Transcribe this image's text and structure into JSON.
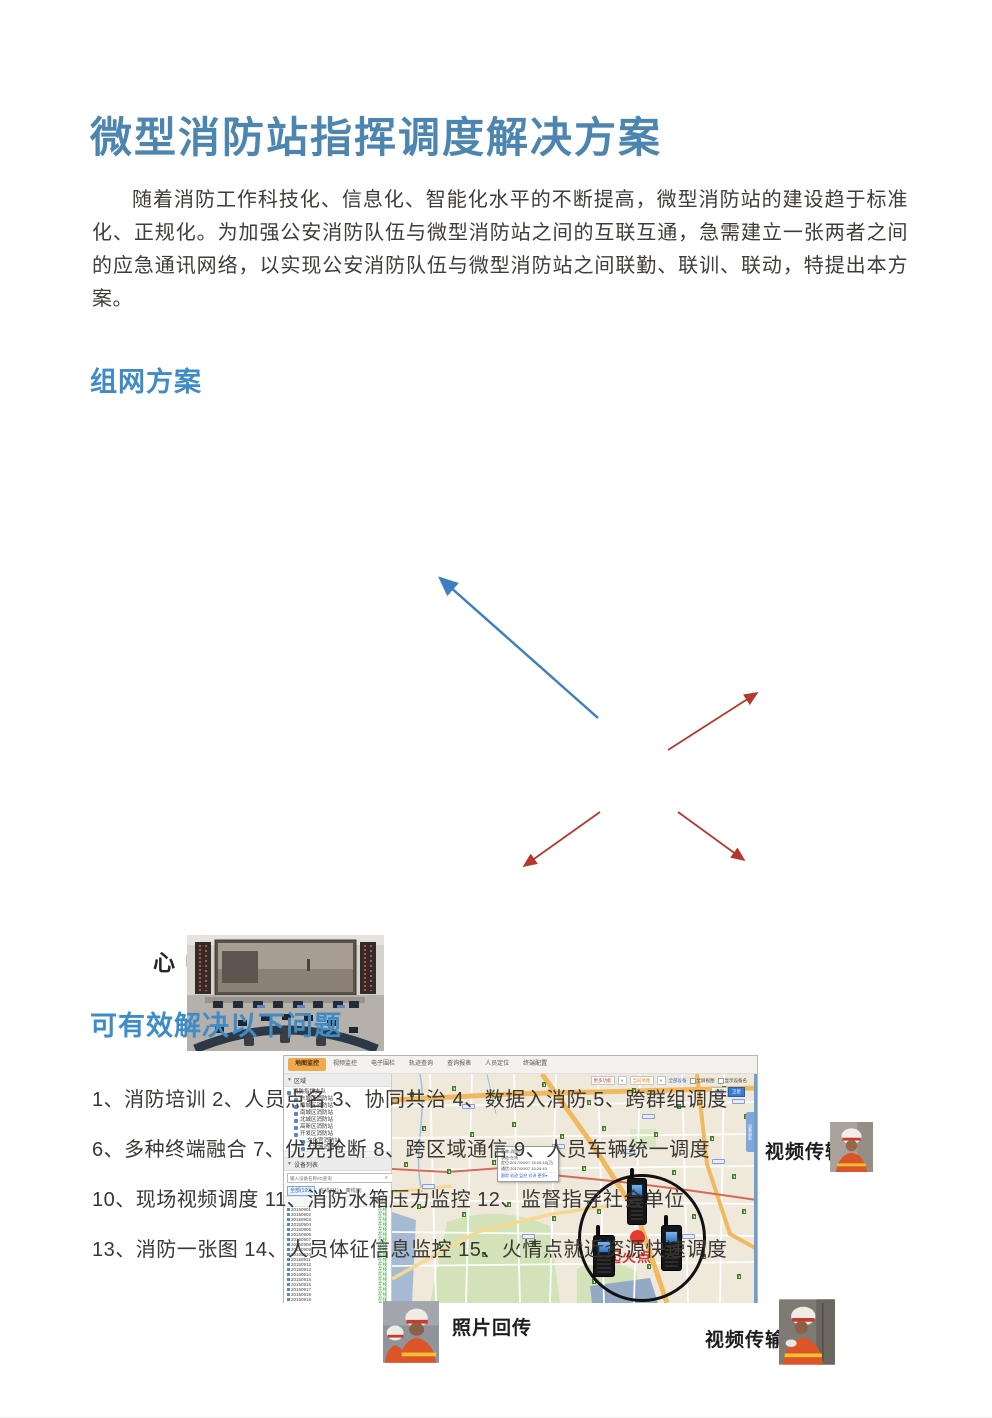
{
  "page": {
    "title": "微型消防站指挥调度解决方案",
    "intro": "随着消防工作科技化、信息化、智能化水平的不断提高，微型消防站的建设趋于标准化、正规化。为加强公安消防队伍与微型消防站之间的互联互通，急需建立一张两者之间的应急通讯网络，以实现公安消防队伍与微型消防站之间联勤、联训、联动，特提出本方案。",
    "section_network": "组网方案",
    "section_problems": "可有效解决以下问题",
    "problem_lines": [
      "1、消防培训  2、人员点名  3、协同共治  4、数据入消防  5、跨群组调度",
      "6、多种终端融合  7、优先抢断  8、跨区域通信  9、人员车辆统一调度",
      "10、现场视频调度  11、消防水箱压力监控  12、监督指导社会单位",
      "13、消防一张图  14、人员体征信息监控  15、火情点就近资源快速调度"
    ]
  },
  "diagram": {
    "command_center_label": "指挥中心",
    "video_label_top": "视频传输",
    "photo_label": "照片回传",
    "video_label_bottom": "视频传输",
    "fire_point_label": "起火点",
    "colors": {
      "heading_blue": "#3e8cc7",
      "title_blue": "#4c86b0",
      "arrow_red": "#b5382e",
      "arrow_blue": "#3d7fc1",
      "fire_red": "#e8392f"
    }
  },
  "map_app": {
    "tabs": [
      "地图监控",
      "视频监控",
      "电子围栏",
      "轨迹查询",
      "查询报表",
      "人员定位",
      "终端配置"
    ],
    "toolbar": {
      "more": "更多功能",
      "basemap": "当前地图",
      "all_devices": "全部设备",
      "chk_fullscreen": "全屏视图",
      "chk_names": "显示设备名",
      "map_btn": "地图",
      "sat_btn": "卫星",
      "side_tab": "设备面板"
    },
    "region_panel": {
      "header": "区域",
      "root": "消防指挥支队",
      "items": [
        "东城区消防站",
        "西城区消防站",
        "南城区消防站",
        "北城区消防站",
        "高新区消防站",
        "开发区消防站"
      ],
      "subitems": [
        "文化宫消防站",
        "大学城消防站"
      ]
    },
    "device_panel": {
      "header": "设备列表",
      "search_placeholder": "输入设备名称/ID查询",
      "filters": [
        "全部(199)",
        "在线(91)",
        "离线(8)"
      ],
      "status_col": "状态",
      "online": "在线",
      "devices": [
        "20150901",
        "20150902",
        "20150903",
        "20150904",
        "20150905",
        "20150906",
        "20150907",
        "20150908",
        "20150909",
        "20150910",
        "20150911",
        "20150912",
        "20150913",
        "20150914",
        "20150915",
        "20150916",
        "20150917",
        "20150918",
        "20150919",
        "20150920",
        "20150921",
        "20150922"
      ]
    },
    "popup": {
      "rows": [
        "名称:消防01",
        "状态:在线",
        "定位:2017/09/07 15:20:43(卫)",
        "通信:2017/09/07 15:20:43"
      ],
      "links": "跟踪 轨迹 监控 对讲 更多▾"
    }
  }
}
